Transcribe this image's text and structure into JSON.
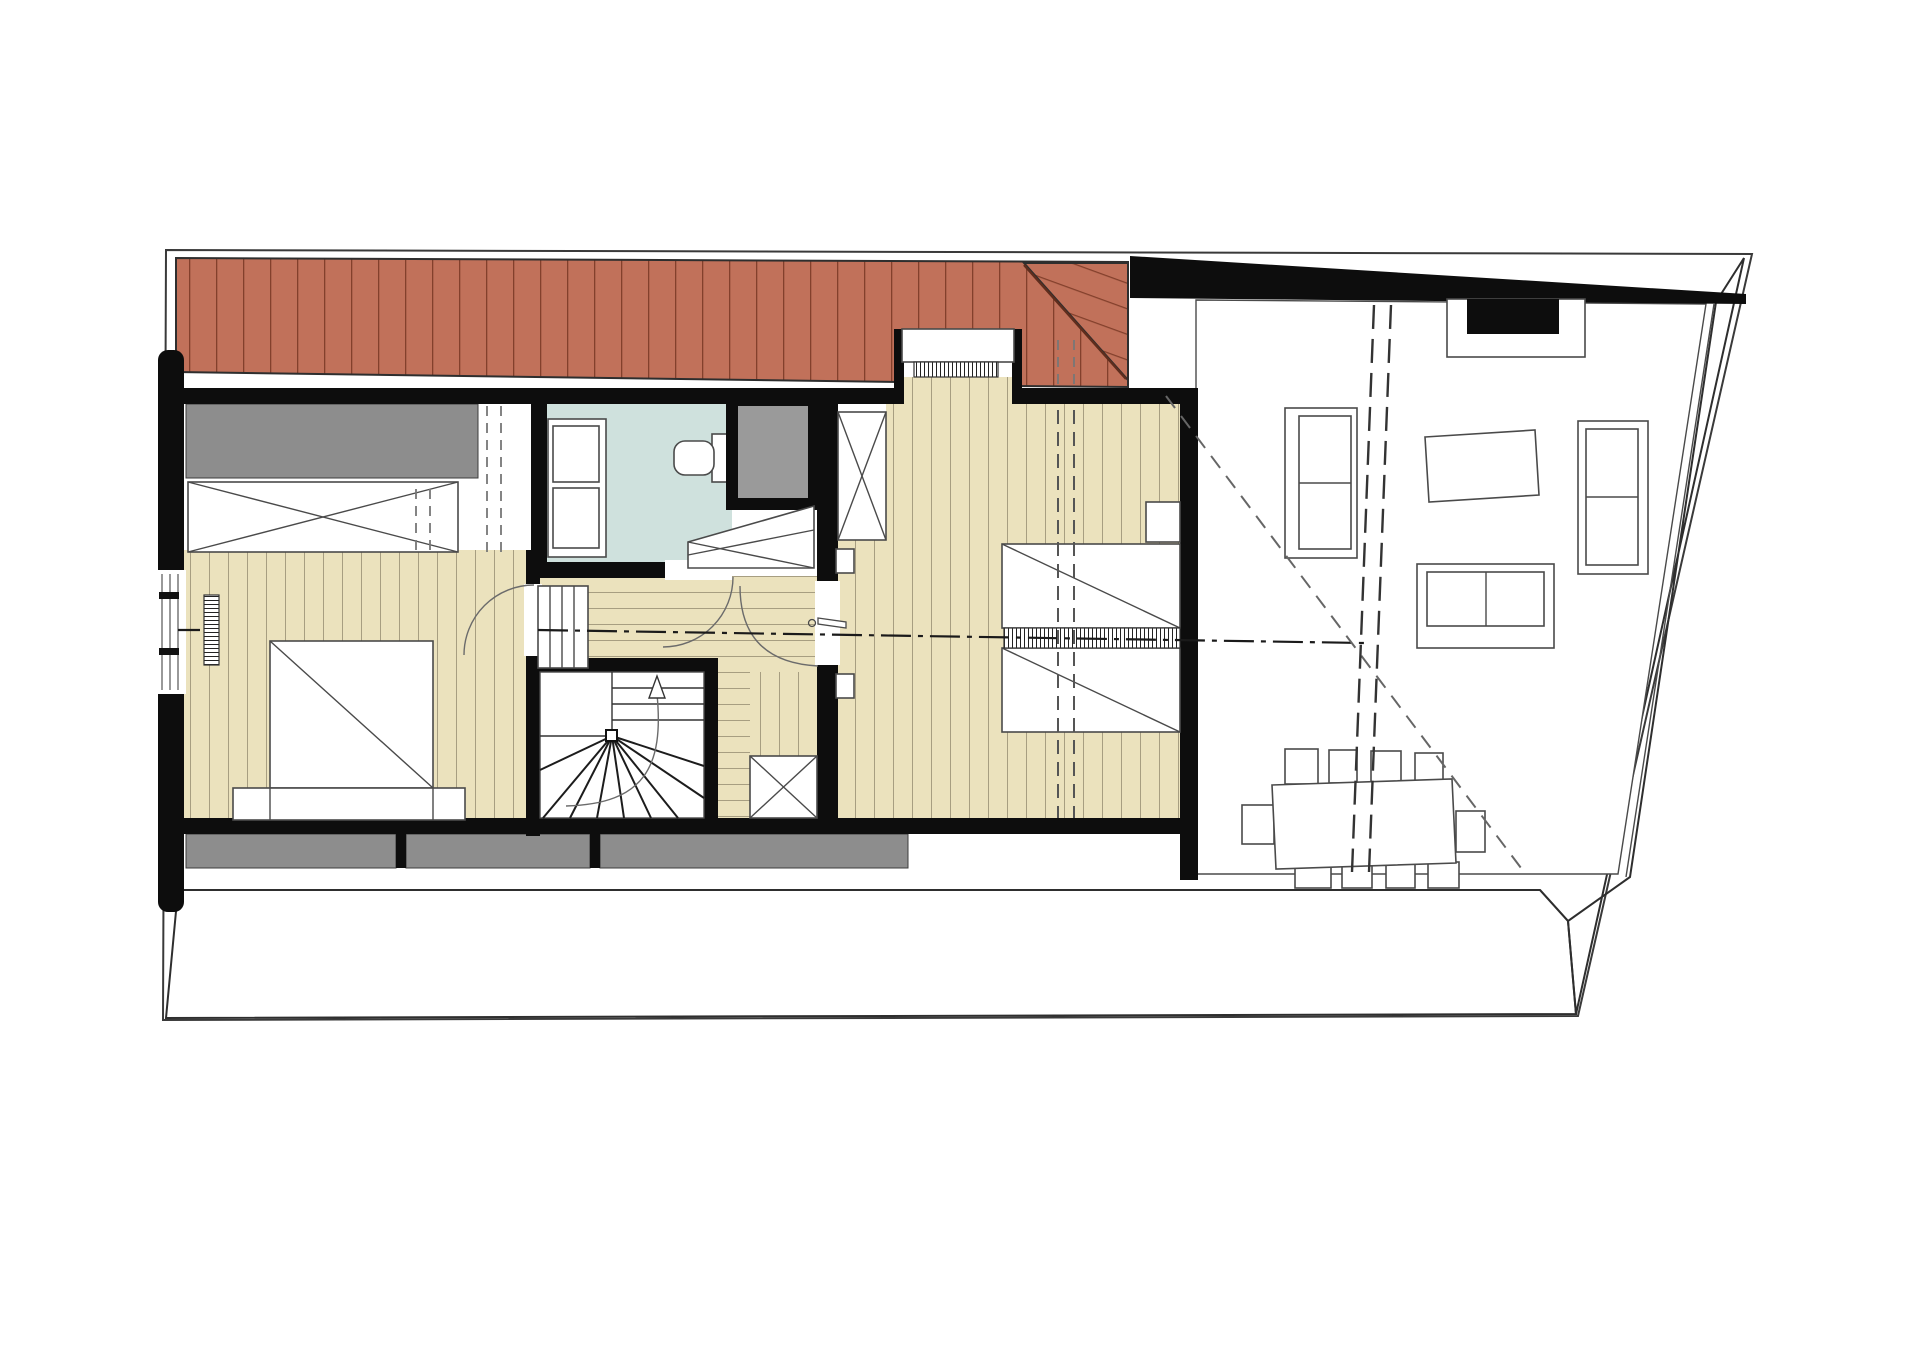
{
  "palette": {
    "roof_red": "#c1715a",
    "roof_line": "#83402c",
    "wood": "#ebe2bd",
    "wood_line": "#a79e81",
    "slope_gray": "#8d8d8d",
    "shower_gray": "#9a9a9a",
    "bath_blue": "#cfe1dd",
    "wall_black": "#0d0d0d",
    "outline_dark": "#3a3a3a",
    "white": "#ffffff"
  },
  "plan": {
    "type": "architectural-floor-plan",
    "rooms": [
      {
        "name": "bedroom-west",
        "floor": "wood-planks-vertical"
      },
      {
        "name": "bathroom",
        "floor": "blue-tile"
      },
      {
        "name": "hallway",
        "floor": "wood-planks-horizontal"
      },
      {
        "name": "winder-staircase",
        "floor": "white"
      },
      {
        "name": "bedroom-middle",
        "floor": "wood-planks-vertical"
      },
      {
        "name": "living-dining-room",
        "floor": "white"
      },
      {
        "name": "dormer-bay",
        "floor": "wood-planks-vertical"
      }
    ],
    "furniture": {
      "bedroom_west": [
        "wardrobe-x",
        "double-bed",
        "foot-bench",
        "radiator",
        "side-window"
      ],
      "bathroom": [
        "vanity-two-basins",
        "toilet",
        "shower-gray",
        "sloped-builtin-closet"
      ],
      "hallway": [
        "shelf-cabinet",
        "door-swing-arcs"
      ],
      "bedroom_middle": [
        "wardrobe-x",
        "twin-bed-upper",
        "twin-bed-lower",
        "low-partition-grille",
        "nightstand",
        "wardrobe-x-south",
        "dormer-vent-grille"
      ],
      "living_dining": [
        "sofa-west",
        "sofa-east",
        "lounge-sofa-south",
        "coffee-table",
        "dining-table",
        "chimney-flue"
      ]
    },
    "counts": {
      "dining_seats": 10,
      "twin_beds": 2,
      "sofas": 3
    },
    "reference_lines": [
      "section-centerline-dashdot",
      "roof-hip-dashed-diagonal",
      "roof-ridge-dashed-pair-middle",
      "roof-ridge-dashed-pair-living",
      "ceiling-height-dashed-pairs"
    ]
  }
}
